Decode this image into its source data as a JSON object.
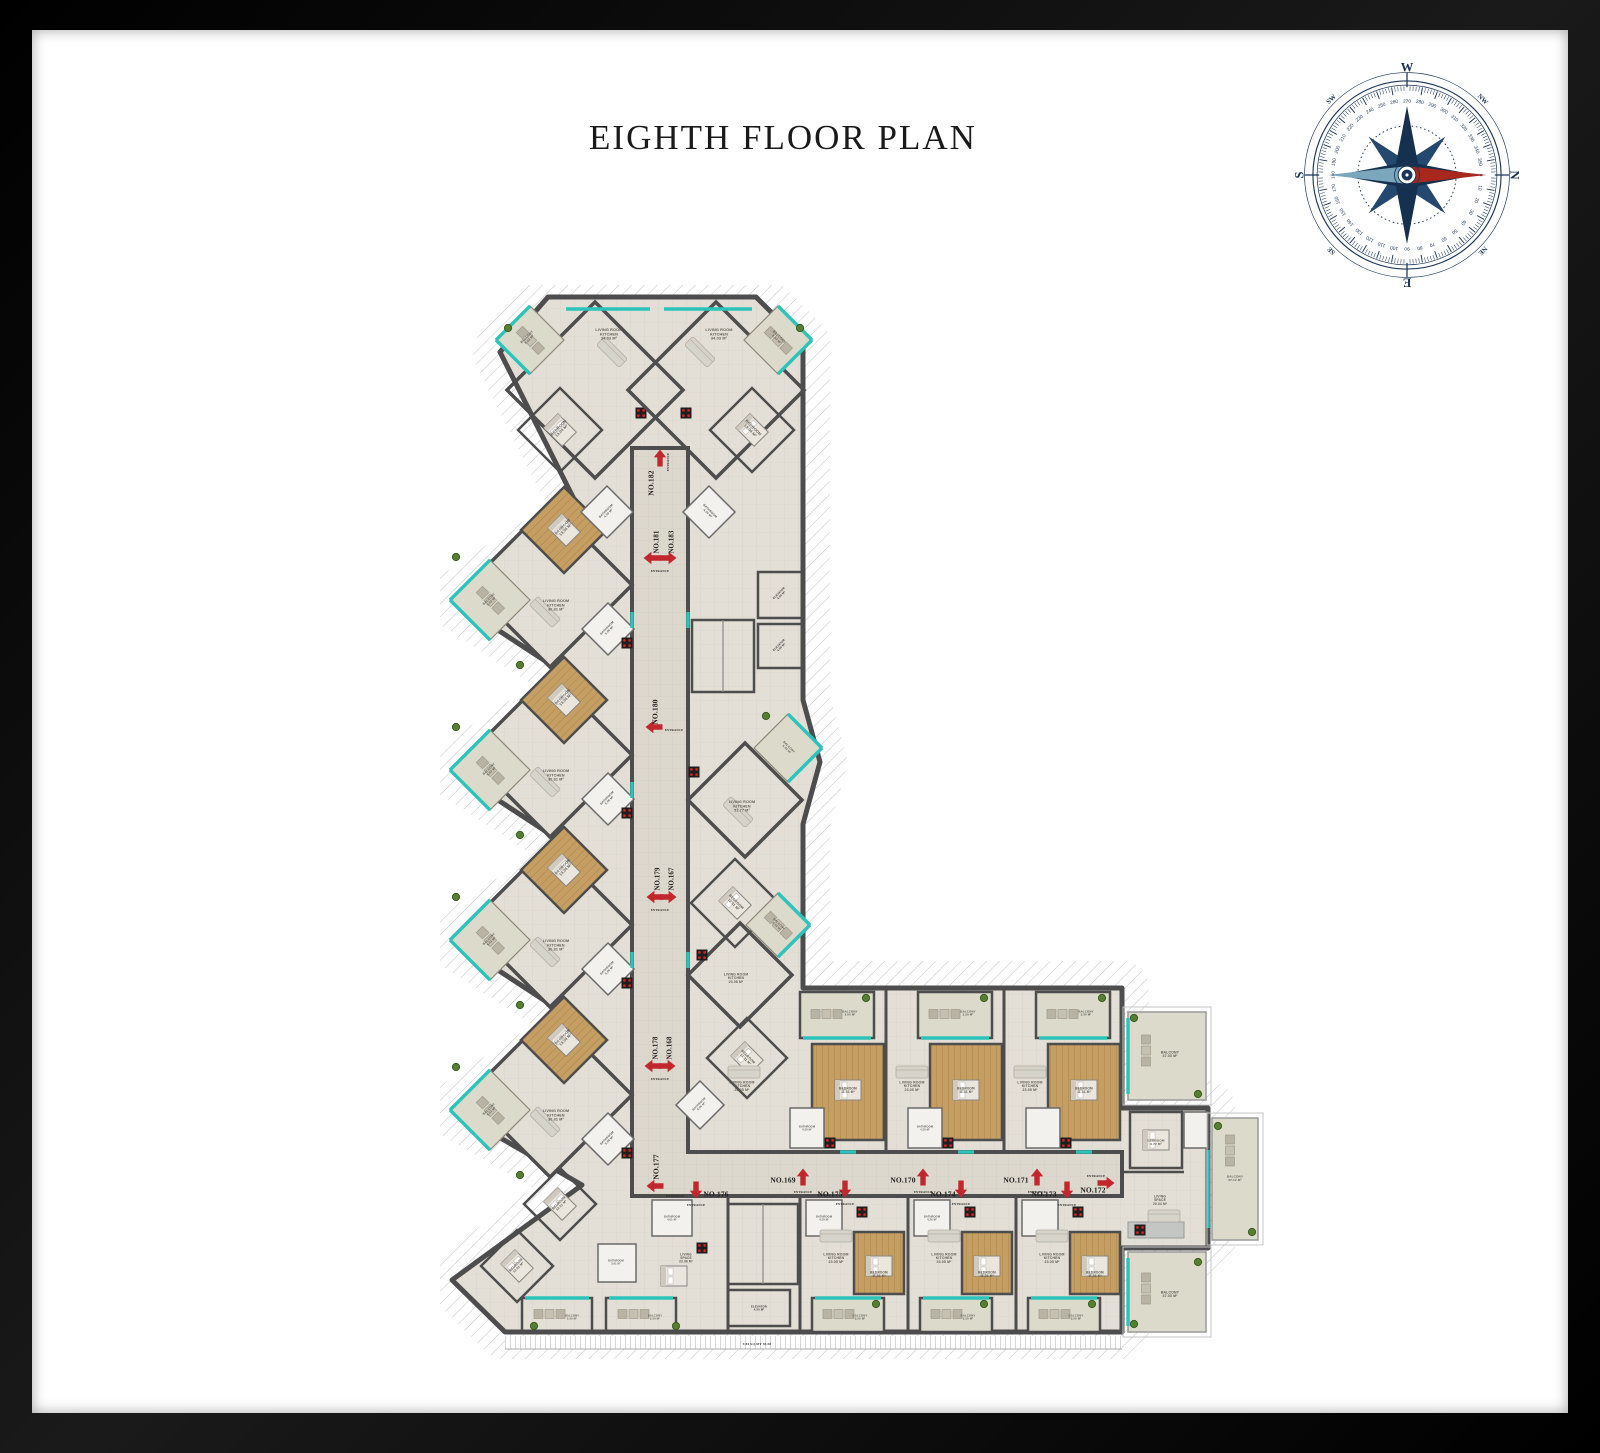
{
  "page": {
    "title": "EIGHTH FLOOR PLAN",
    "background": "#ffffff",
    "frame_color": "#050505"
  },
  "compass": {
    "ring_color": "#1c3557",
    "needle_red": "#a9281e",
    "needle_blue": "#7ba7bd",
    "degree_labels": [
      0,
      10,
      20,
      30,
      40,
      50,
      60,
      70,
      80,
      90,
      100,
      110,
      120,
      130,
      140,
      150,
      160,
      170,
      180,
      190,
      200,
      210,
      220,
      230,
      240,
      250,
      260,
      270,
      280,
      290,
      300,
      310,
      320,
      330,
      340,
      350
    ],
    "points": [
      {
        "l": "N",
        "a": 0,
        "s": 12,
        "rad": 103
      },
      {
        "l": "NE",
        "a": 45,
        "s": 6.5,
        "rad": 102
      },
      {
        "l": "E",
        "a": 90,
        "s": 12,
        "rad": 103
      },
      {
        "l": "SE",
        "a": 135,
        "s": 6.5,
        "rad": 102
      },
      {
        "l": "S",
        "a": 180,
        "s": 12,
        "rad": 103
      },
      {
        "l": "SW",
        "a": 225,
        "s": 6.5,
        "rad": 102
      },
      {
        "l": "W",
        "a": 270,
        "s": 12,
        "rad": 103
      },
      {
        "l": "NW",
        "a": 315,
        "s": 6.5,
        "rad": 102
      }
    ]
  },
  "plan": {
    "colors": {
      "walls": "#4d4d4d",
      "glazing_teal": "#2cc4ba",
      "entrance_red": "#c1272d",
      "wood_floor": "#c49e63",
      "tile_floor": "#e3dfd6",
      "corridor_floor": "#dcd8cd",
      "balcony_floor": "#dbdacb",
      "elevator": "#9b8588",
      "terrace_hatch": "#c2c2c2"
    },
    "arrows": [
      {
        "dir": "up",
        "x": 660,
        "y": 458
      },
      {
        "dir": "left",
        "x": 652,
        "y": 558
      },
      {
        "dir": "right",
        "x": 668,
        "y": 558
      },
      {
        "dir": "left",
        "x": 654,
        "y": 727
      },
      {
        "dir": "left",
        "x": 655,
        "y": 897
      },
      {
        "dir": "right",
        "x": 668,
        "y": 897
      },
      {
        "dir": "left",
        "x": 653,
        "y": 1066
      },
      {
        "dir": "right",
        "x": 667,
        "y": 1066
      },
      {
        "dir": "left",
        "x": 655,
        "y": 1186
      },
      {
        "dir": "down",
        "x": 696,
        "y": 1190
      },
      {
        "dir": "up",
        "x": 803,
        "y": 1177
      },
      {
        "dir": "down",
        "x": 845,
        "y": 1189
      },
      {
        "dir": "up",
        "x": 923,
        "y": 1177
      },
      {
        "dir": "down",
        "x": 961,
        "y": 1189
      },
      {
        "dir": "up",
        "x": 1037,
        "y": 1177
      },
      {
        "dir": "down",
        "x": 1067,
        "y": 1190
      },
      {
        "dir": "right",
        "x": 1106,
        "y": 1183
      }
    ],
    "labels": [
      {
        "t": "NO.182",
        "x": 651,
        "y": 483,
        "r": -90,
        "s": 7.5,
        "f": "serif",
        "c": "#1b1b1b"
      },
      {
        "t": "NO.181",
        "x": 656,
        "y": 542,
        "r": -90,
        "s": 6.8,
        "f": "serif",
        "c": "#1b1b1b"
      },
      {
        "t": "NO.183",
        "x": 671,
        "y": 542,
        "r": -90,
        "s": 6.8,
        "f": "serif",
        "c": "#1b1b1b"
      },
      {
        "t": "NO.180",
        "x": 655,
        "y": 712,
        "r": -90,
        "s": 7.5,
        "f": "serif",
        "c": "#1b1b1b"
      },
      {
        "t": "NO.179",
        "x": 657,
        "y": 879,
        "r": -90,
        "s": 6.8,
        "f": "serif",
        "c": "#1b1b1b"
      },
      {
        "t": "NO.167",
        "x": 671,
        "y": 879,
        "r": -90,
        "s": 6.8,
        "f": "serif",
        "c": "#1b1b1b"
      },
      {
        "t": "NO.178",
        "x": 655,
        "y": 1048,
        "r": -90,
        "s": 6.8,
        "f": "serif",
        "c": "#1b1b1b"
      },
      {
        "t": "NO.168",
        "x": 669,
        "y": 1048,
        "r": -90,
        "s": 6.8,
        "f": "serif",
        "c": "#1b1b1b"
      },
      {
        "t": "NO.177",
        "x": 656,
        "y": 1167,
        "r": -90,
        "s": 7.5,
        "f": "serif",
        "c": "#1b1b1b"
      },
      {
        "t": "NO.176",
        "x": 716,
        "y": 1194,
        "s": 7.5,
        "f": "serif",
        "c": "#1b1b1b"
      },
      {
        "t": "NO.169",
        "x": 783,
        "y": 1180,
        "s": 7.5,
        "f": "serif",
        "c": "#1b1b1b"
      },
      {
        "t": "NO.175",
        "x": 830,
        "y": 1194,
        "s": 7.5,
        "f": "serif",
        "c": "#1b1b1b"
      },
      {
        "t": "NO.170",
        "x": 903,
        "y": 1180,
        "s": 7.5,
        "f": "serif",
        "c": "#1b1b1b"
      },
      {
        "t": "NO.174",
        "x": 943,
        "y": 1194,
        "s": 7.5,
        "f": "serif",
        "c": "#1b1b1b"
      },
      {
        "t": "NO.171",
        "x": 1016,
        "y": 1180,
        "s": 7.5,
        "f": "serif",
        "c": "#1b1b1b"
      },
      {
        "t": "NO.173",
        "x": 1044,
        "y": 1194,
        "s": 7.5,
        "f": "serif",
        "c": "#1b1b1b"
      },
      {
        "t": "NO.172",
        "x": 1093,
        "y": 1190,
        "s": 7.5,
        "f": "serif",
        "c": "#1b1b1b"
      },
      {
        "t": "ENTRANCE",
        "x": 668,
        "y": 462,
        "r": -90,
        "s": 3.1,
        "f": "serif",
        "c": "#2a2a2a"
      },
      {
        "t": "ENTRANCE",
        "x": 660,
        "y": 571,
        "s": 3.1,
        "f": "serif",
        "c": "#2a2a2a"
      },
      {
        "t": "ENTRANCE",
        "x": 674,
        "y": 730,
        "s": 3.1,
        "f": "serif",
        "c": "#2a2a2a"
      },
      {
        "t": "ENTRANCE",
        "x": 660,
        "y": 910,
        "s": 3.1,
        "f": "serif",
        "c": "#2a2a2a"
      },
      {
        "t": "ENTRANCE",
        "x": 660,
        "y": 1079,
        "s": 3.1,
        "f": "serif",
        "c": "#2a2a2a"
      },
      {
        "t": "ENTRANCE",
        "x": 675,
        "y": 1196,
        "s": 3.1,
        "f": "serif",
        "c": "#2a2a2a"
      },
      {
        "t": "ENTRANCE",
        "x": 696,
        "y": 1205,
        "s": 3.1,
        "f": "serif",
        "c": "#2a2a2a"
      },
      {
        "t": "ENTRANCE",
        "x": 803,
        "y": 1192,
        "s": 3.1,
        "f": "serif",
        "c": "#2a2a2a"
      },
      {
        "t": "ENTRANCE",
        "x": 845,
        "y": 1204,
        "s": 3.1,
        "f": "serif",
        "c": "#2a2a2a"
      },
      {
        "t": "ENTRANCE",
        "x": 923,
        "y": 1192,
        "s": 3.1,
        "f": "serif",
        "c": "#2a2a2a"
      },
      {
        "t": "ENTRANCE",
        "x": 961,
        "y": 1204,
        "s": 3.1,
        "f": "serif",
        "c": "#2a2a2a"
      },
      {
        "t": "ENTRANCE",
        "x": 1037,
        "y": 1192,
        "s": 3.1,
        "f": "serif",
        "c": "#2a2a2a"
      },
      {
        "t": "ENTRANCE",
        "x": 1067,
        "y": 1205,
        "s": 3.1,
        "f": "serif",
        "c": "#2a2a2a"
      },
      {
        "t": "ENTRANCE",
        "x": 1096,
        "y": 1176,
        "s": 3.1,
        "f": "serif",
        "c": "#2a2a2a"
      },
      {
        "t": "LIVING ROOM\nKITCHEN\n34.03 M²",
        "x": 609,
        "y": 334
      },
      {
        "t": "LIVING ROOM\nKITCHEN\n34.03 M²",
        "x": 719,
        "y": 334
      },
      {
        "t": "BEDROOM\n13.04 M²",
        "x": 560,
        "y": 429,
        "r": -45,
        "s": 3.8
      },
      {
        "t": "BEDROOM\n13.04 M²",
        "x": 752,
        "y": 429,
        "r": 45,
        "s": 3.8
      },
      {
        "t": "BALCONY\n8.02 M²",
        "x": 528,
        "y": 338,
        "r": -45,
        "s": 3.2
      },
      {
        "t": "BALCONY\n8.02 M²",
        "x": 778,
        "y": 338,
        "r": 45,
        "s": 3.2
      },
      {
        "t": "BATHROOM\n4.30 M²",
        "x": 607,
        "y": 512,
        "r": -45,
        "s": 3
      },
      {
        "t": "BATHROOM\n4.30 M²",
        "x": 709,
        "y": 512,
        "r": 45,
        "s": 3
      },
      {
        "t": "BEDROOM\n13.04 M²",
        "x": 564,
        "y": 528,
        "r": -45,
        "s": 3.7
      },
      {
        "t": "LIVING ROOM\nKITCHEN\n30.81 M²",
        "x": 556,
        "y": 605,
        "s": 3.7
      },
      {
        "t": "BALCONY\n5.02 M²",
        "x": 490,
        "y": 600,
        "r": -45,
        "s": 3
      },
      {
        "t": "BATHROOM\n5.06 M²",
        "x": 608,
        "y": 629,
        "r": -45,
        "s": 2.9
      },
      {
        "t": "BEDROOM\n13.04 M²",
        "x": 564,
        "y": 698,
        "r": -45,
        "s": 3.7
      },
      {
        "t": "LIVING ROOM\nKITCHEN\n30.81 M²",
        "x": 556,
        "y": 775,
        "s": 3.7
      },
      {
        "t": "BALCONY\n5.02 M²",
        "x": 490,
        "y": 770,
        "r": -45,
        "s": 3
      },
      {
        "t": "BATHROOM\n5.06 M²",
        "x": 608,
        "y": 799,
        "r": -45,
        "s": 2.9
      },
      {
        "t": "BEDROOM\n13.04 M²",
        "x": 564,
        "y": 868,
        "r": -45,
        "s": 3.7
      },
      {
        "t": "LIVING ROOM\nKITCHEN\n30.81 M²",
        "x": 556,
        "y": 945,
        "s": 3.7
      },
      {
        "t": "BALCONY\n5.02 M²",
        "x": 490,
        "y": 940,
        "r": -45,
        "s": 3
      },
      {
        "t": "BATHROOM\n5.06 M²",
        "x": 608,
        "y": 969,
        "r": -45,
        "s": 2.9
      },
      {
        "t": "BEDROOM\n13.04 M²",
        "x": 564,
        "y": 1038,
        "r": -45,
        "s": 3.7
      },
      {
        "t": "LIVING ROOM\nKITCHEN\n30.81 M²",
        "x": 556,
        "y": 1115,
        "s": 3.7
      },
      {
        "t": "BALCONY\n5.02 M²",
        "x": 490,
        "y": 1110,
        "r": -45,
        "s": 3
      },
      {
        "t": "BATHROOM\n5.06 M²",
        "x": 608,
        "y": 1139,
        "r": -45,
        "s": 2.9
      },
      {
        "t": "LIVING ROOM\nKITCHEN\n51.77 M²",
        "x": 742,
        "y": 806,
        "s": 3.7
      },
      {
        "t": "BEDROOM\n12.51 M²",
        "x": 735,
        "y": 903,
        "r": 45,
        "s": 3.5
      },
      {
        "t": "BALCONY\n5.02 M²",
        "x": 788,
        "y": 748,
        "r": 45,
        "s": 2.9
      },
      {
        "t": "LIVING ROOM\nKITCHEN\n23.08 M²",
        "x": 736,
        "y": 978,
        "s": 3.4
      },
      {
        "t": "BEDROOM\n11.31 M²",
        "x": 747,
        "y": 1058,
        "r": 45,
        "s": 3.3
      },
      {
        "t": "BALCONY\n5.02 M²",
        "x": 778,
        "y": 925,
        "r": 45,
        "s": 2.9
      },
      {
        "t": "BATHROOM\n5.06 M²",
        "x": 700,
        "y": 1105,
        "r": -45,
        "s": 2.8
      },
      {
        "t": "ELEVATOR\n4.50 M²",
        "x": 780,
        "y": 594,
        "r": -45,
        "s": 2.8,
        "c": "#3d3335"
      },
      {
        "t": "ELEVATOR\n4.50 M²",
        "x": 780,
        "y": 646,
        "r": -45,
        "s": 2.8,
        "c": "#3d3335"
      },
      {
        "t": "ELEVATOR\n4.50 M²",
        "x": 759,
        "y": 1308,
        "s": 2.8,
        "c": "#3d3335"
      },
      {
        "t": "LIVING ROOM\nKITCHEN\n23.05 M²",
        "x": 742,
        "y": 1086,
        "s": 3.5
      },
      {
        "t": "LIVING ROOM\nKITCHEN\n23.05 M²",
        "x": 912,
        "y": 1086,
        "s": 3.5
      },
      {
        "t": "LIVING ROOM\nKITCHEN\n23.05 M²",
        "x": 1030,
        "y": 1086,
        "s": 3.5
      },
      {
        "t": "BEDROOM\n11.31 M²",
        "x": 848,
        "y": 1090,
        "s": 3.2
      },
      {
        "t": "BEDROOM\n11.31 M²",
        "x": 966,
        "y": 1090,
        "s": 3.2
      },
      {
        "t": "BEDROOM\n11.31 M²",
        "x": 1084,
        "y": 1090,
        "s": 3.2
      },
      {
        "t": "BALCONY\n3.50 M²",
        "x": 850,
        "y": 1013,
        "s": 2.9
      },
      {
        "t": "BALCONY\n3.50 M²",
        "x": 968,
        "y": 1013,
        "s": 2.9
      },
      {
        "t": "BALCONY\n3.50 M²",
        "x": 1086,
        "y": 1013,
        "s": 2.9
      },
      {
        "t": "BATHROOM\n4.20 M²",
        "x": 807,
        "y": 1128,
        "s": 2.6
      },
      {
        "t": "BATHROOM\n4.20 M²",
        "x": 925,
        "y": 1128,
        "s": 2.6
      },
      {
        "t": "LIVING ROOM\nKITCHEN\n23.05 M²",
        "x": 836,
        "y": 1258,
        "s": 3.5
      },
      {
        "t": "LIVING ROOM\nKITCHEN\n23.05 M²",
        "x": 944,
        "y": 1258,
        "s": 3.5
      },
      {
        "t": "LIVING ROOM\nKITCHEN\n23.05 M²",
        "x": 1052,
        "y": 1258,
        "s": 3.5
      },
      {
        "t": "BEDROOM\n11.31 M²",
        "x": 879,
        "y": 1274,
        "s": 3.2
      },
      {
        "t": "BEDROOM\n11.31 M²",
        "x": 987,
        "y": 1274,
        "s": 3.2
      },
      {
        "t": "BEDROOM\n11.31 M²",
        "x": 1095,
        "y": 1274,
        "s": 3.2
      },
      {
        "t": "BALCONY\n3.50 M²",
        "x": 860,
        "y": 1317,
        "s": 2.8
      },
      {
        "t": "BALCONY\n3.50 M²",
        "x": 968,
        "y": 1317,
        "s": 2.8
      },
      {
        "t": "BALCONY\n3.50 M²",
        "x": 1076,
        "y": 1317,
        "s": 2.8
      },
      {
        "t": "BATHROOM\n4.20 M²",
        "x": 824,
        "y": 1218,
        "s": 2.6
      },
      {
        "t": "BATHROOM\n4.20 M²",
        "x": 932,
        "y": 1218,
        "s": 2.6
      },
      {
        "t": "BATHROOM\n4.01 M²",
        "x": 672,
        "y": 1218,
        "s": 2.6
      },
      {
        "t": "LIVING\nSPACE\n23.08 M²",
        "x": 686,
        "y": 1258,
        "s": 3.2
      },
      {
        "t": "BEDROOM\n12.51 M²",
        "x": 560,
        "y": 1204,
        "r": -45,
        "s": 3.2
      },
      {
        "t": "BEDROOM\n12.51 M²",
        "x": 517,
        "y": 1266,
        "r": -45,
        "s": 3.2
      },
      {
        "t": "BATHROOM\n3.61 M²",
        "x": 616,
        "y": 1262,
        "s": 2.5
      },
      {
        "t": "BALCONY\n3.50 M²",
        "x": 572,
        "y": 1317,
        "s": 2.7
      },
      {
        "t": "BALCONY\n3.50 M²",
        "x": 655,
        "y": 1317,
        "s": 2.7
      },
      {
        "t": "LIVING\nSPACE\n25.04 M²",
        "x": 1160,
        "y": 1200,
        "s": 3.3
      },
      {
        "t": "BEDROOM\n9.72 M²",
        "x": 1156,
        "y": 1142,
        "s": 3.1
      },
      {
        "t": "BALCONY\n47.03 M²",
        "x": 1170,
        "y": 1054,
        "s": 3.5
      },
      {
        "t": "BALCONY\n37.12 M²",
        "x": 1235,
        "y": 1178,
        "s": 3.1
      },
      {
        "t": "BALCONY\n47.03 M²",
        "x": 1170,
        "y": 1294,
        "s": 3.5
      },
      {
        "t": "9.84 SQ.MT 93.08",
        "x": 757,
        "y": 1344,
        "s": 3.4,
        "f": "serif",
        "c": "#3c3c3c"
      }
    ]
  }
}
